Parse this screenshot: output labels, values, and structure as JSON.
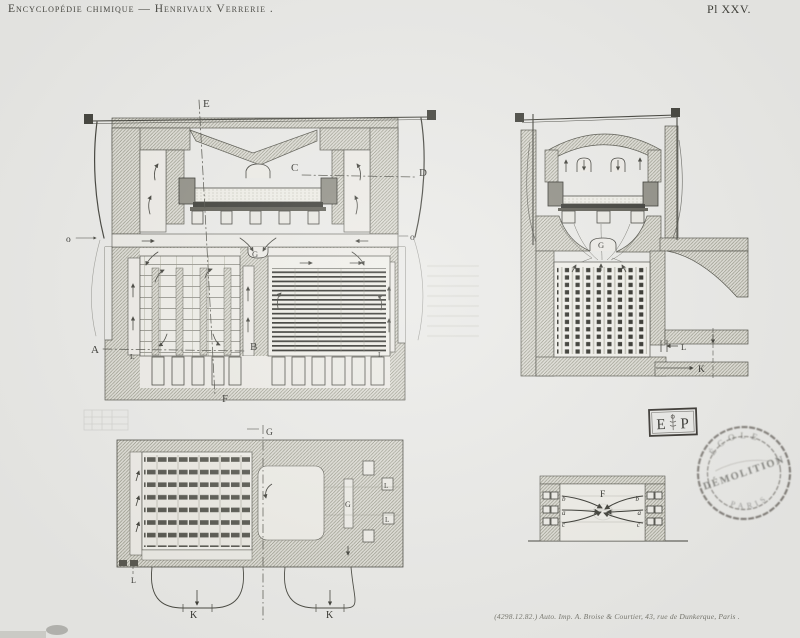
{
  "plate": {
    "title": "Encyclopédie chimique — Henrivaux Verrerie .",
    "number": "Pl XXV.",
    "imprint": "(4298.12.82.)  Auto. Imp. A. Broise & Courtier, 43, rue de Dunkerque, Paris ."
  },
  "figures": {
    "longitudinal_section": {
      "labels": {
        "E": "E",
        "F": "F",
        "C": "C",
        "D": "D",
        "A": "A",
        "B": "B",
        "G": "G",
        "o": "o",
        "L": "L"
      }
    },
    "transverse_section": {
      "labels": {
        "G": "G",
        "L": "L",
        "K": "K"
      }
    },
    "plan": {
      "labels": {
        "G": "G",
        "L": "L",
        "K": "K"
      }
    },
    "port_detail": {
      "labels": {
        "F": "F",
        "a": "a",
        "b": "b",
        "c": "c"
      }
    }
  },
  "stamps": {
    "ep": {
      "left_letter": "E",
      "right_letter": "P"
    },
    "round": {
      "arc_top": "ÉCOLE",
      "arc_bottom": "PARIS",
      "overprint": "DÉMOLITION"
    }
  },
  "colors": {
    "paper": "#e9e9e6",
    "ink": "#3a3a34",
    "stamp_ink": "#454039"
  }
}
